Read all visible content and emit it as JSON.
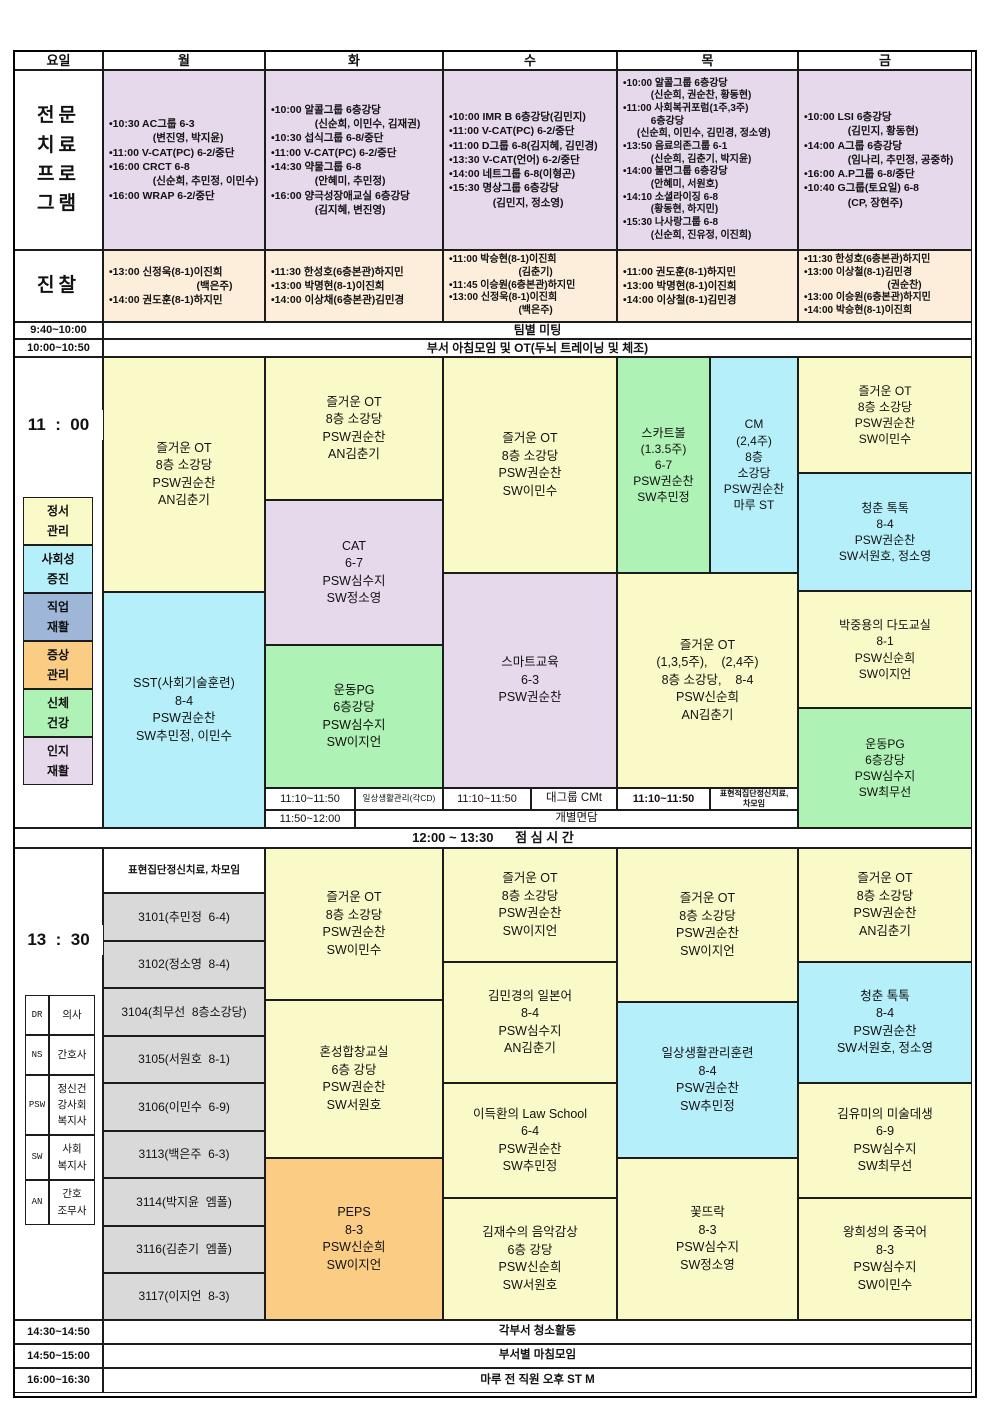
{
  "palette": {
    "category_yellow": "#fafac8",
    "category_cyan": "#b5f0fa",
    "category_blue": "#9eb6d8",
    "category_orange": "#fbcc84",
    "category_green": "#aef2b5",
    "category_lavender": "#e7d9ec",
    "exam_cream": "#fdeedb",
    "room_gray": "#d9d9d9"
  },
  "header": {
    "c0": "요일",
    "c1": "월",
    "c2": "화",
    "c3": "수",
    "c4": "목",
    "c5": "금"
  },
  "program": {
    "label": "전문\n치료\n프로\n그램",
    "mon": "•10:30 AC그룹 6-3\n               (변진영, 박지윤)\n•11:00 V-CAT(PC) 6-2/중단\n•16:00 CRCT 6-8\n               (신순희, 추민정, 이민수)\n•16:00 WRAP 6-2/중단",
    "tue": "•10:00 알콜그룹 6층강당\n               (신순희, 이민수, 김재권)\n•10:30 섭식그룹 6-8/중단\n•11:00 V-CAT(PC) 6-2/중단\n•14:30 약물그룹 6-8\n               (안혜미, 추민정)\n•16:00 양극성장애교실 6층강당\n               (김지혜, 변진영)",
    "wed": "•10:00 IMR B 6층강당(김민지)\n•11:00 V-CAT(PC) 6-2/중단\n•11:00 D그룹 6-8(김지혜, 김민경)\n•13:30 V-CAT(언어) 6-2/중단\n•14:00 네트그룹 6-8(이형곤)\n•15:30 명상그룹 6층강당\n               (김민지, 정소영)",
    "thu": "•10:00 알콜그룹 6층강당\n          (신순희, 권순찬, 황동현)\n•11:00 사회복귀포럼(1주,3주)\n          6층강당\n     (신순희, 이민수, 김민경, 정소영)\n•13:50 음료의존그룹 6-1\n          (신순희, 김춘기, 박지윤)\n•14:00 불면그룹 6층강당\n          (안혜미, 서원호)\n•14:10 소셜라이징 6-8\n          (황동현, 하지민)\n•15:30 나사랑그룹 6-8\n          (신순희, 진유정, 이진희)",
    "fri": "•10:00 LSI 6층강당\n               (김민지, 황동현)\n•14:00 A그룹 6층강당\n               (임나리, 추민정, 공중하)\n•16:00 A.P그룹 6-8/중단\n•10:40 G그룹(토요일) 6-8\n               (CP, 장현주)"
  },
  "exam": {
    "label": "진찰",
    "mon": "•13:00 신정욱(8-1)이진희\n                              (백은주)\n•14:00 권도훈(8-1)하지민",
    "tue": "•11:30 한성호(6층본관)하지민\n•13:00 박명현(8-1)이진희\n•14:00 이상채(6층본관)김민경",
    "wed": "•11:00 박승현(8-1)이진희\n                         (김춘기)\n•11:45 이승원(6층본관)하지민\n•13:00 신정욱(8-1)이진희\n                         (백은주)",
    "thu": "•11:00 권도훈(8-1)하지민\n•13:00 박명현(8-1)이진희\n•14:00 이상철(8-1)김민경",
    "fri": "•11:30 한성호(6층본관)하지민\n•13:00 이상철(8-1)김민경\n                              (권순찬)\n•13:00 이승원(6층본관)하지민\n•14:00 박승현(8-1)이진희"
  },
  "rows": {
    "team_time": "9:40~10:00",
    "team_text": "팀별 미팅",
    "morning_time": "10:00~10:50",
    "morning_text": "부서 아침모임 및 OT(두뇌 트레이닝 및 체조)",
    "lunch_text": "12:00 ~ 13:30      점 심 시 간",
    "clean_time": "14:30~14:50",
    "clean_text": "각부서 청소활동",
    "close_time": "14:50~15:00",
    "close_text": "부서별 마침모임",
    "st_time": "16:00~16:30",
    "st_text": "마루 전 직원 오후 ST M"
  },
  "s11": {
    "time_label": "11  :  00",
    "legend": [
      {
        "label": "정서\n관리",
        "color": "#fafac8"
      },
      {
        "label": "사회성\n증진",
        "color": "#b5f0fa"
      },
      {
        "label": "직업\n재활",
        "color": "#9eb6d8"
      },
      {
        "label": "증상\n관리",
        "color": "#fbcc84"
      },
      {
        "label": "신체\n건강",
        "color": "#aef2b5"
      },
      {
        "label": "인지\n재활",
        "color": "#e7d9ec"
      }
    ],
    "mon": {
      "ot": "즐거운 OT\n8층 소강당\nPSW권순찬\nAN김춘기",
      "sst": "SST(사회기술훈련)\n8-4\nPSW권순찬\nSW추민정, 이민수"
    },
    "tue": {
      "ot": "즐거운 OT\n8층 소강당\nPSW권순찬\nAN김춘기",
      "cat": "CAT\n6-7\nPSW심수지\nSW정소영",
      "pg": "운동PG\n6층강당\nPSW심수지\nSW이지언",
      "t1": "11:10~11:50",
      "t1_text": "일상생활관리(각CD)",
      "t2": "11:50~12:00"
    },
    "wed": {
      "ot": "즐거운 OT\n8층 소강당\nPSW권순찬\nSW이민수",
      "smart": "스마트교육\n6-3\nPSW권순찬",
      "t1": "11:10~11:50",
      "t1_text": "대그룹 CMt"
    },
    "thu": {
      "skat": "스카트볼\n(1.3.5주)\n6-7\nPSW권순찬\nSW추민정",
      "cm": "CM\n(2,4주)\n8층\n소강당\nPSW권순찬\n마루 ST",
      "ot": "즐거운 OT\n(1,3,5주),    (2,4주)\n8층 소강당,    8-4\nPSW신순희\nAN김춘기",
      "t1": "11:10~11:50",
      "t1_text": "표현적집단정신치료,\n차모임"
    },
    "fri": {
      "ot": "즐거운 OT\n8층 소강당\nPSW권순찬\nSW이민수",
      "talk": "청춘 톡톡\n8-4\nPSW권순찬\nSW서원호, 정소영",
      "tea": "박중용의 다도교실\n8-1\nPSW신순희\nSW이지언",
      "pg": "운동PG\n6층강당\nPSW심수지\nSW최무선"
    },
    "consult": "개별면담"
  },
  "s13": {
    "time_label": "13  :  30",
    "legend": [
      {
        "code": "DR",
        "label": "의사"
      },
      {
        "code": "NS",
        "label": "간호사"
      },
      {
        "code": "PSW",
        "label": "정신건\n강사회\n복지사"
      },
      {
        "code": "SW",
        "label": "사회\n복지사"
      },
      {
        "code": "AN",
        "label": "간호\n조무사"
      }
    ],
    "mon": [
      "표현집단정신치료, 차모임",
      "3101(추민정  6-4)",
      "3102(정소영  8-4)",
      "3104(최무선  8층소강당)",
      "3105(서원호  8-1)",
      "3106(이민수  6-9)",
      "3113(백은주  6-3)",
      "3114(박지윤  엠폴)",
      "3116(김춘기  엠폴)",
      "3117(이지언  8-3)"
    ],
    "tue": [
      "즐거운 OT\n8층 소강당\nPSW권순찬\nSW이민수",
      "혼성합창교실\n6층 강당\nPSW권순찬\nSW서원호",
      "PEPS\n8-3\nPSW신순희\nSW이지언"
    ],
    "wed": [
      "즐거운 OT\n8층 소강당\nPSW권순찬\nSW이지언",
      "김민경의 일본어\n8-4\nPSW심수지\nAN김춘기",
      "이득환의 Law School\n6-4\nPSW권순찬\nSW추민정",
      "김재수의 음악감상\n6층 강당\nPSW신순희\nSW서원호"
    ],
    "thu": [
      "즐거운 OT\n8층 소강당\nPSW권순찬\nSW이지언",
      "일상생활관리훈련\n8-4\nPSW권순찬\nSW추민정",
      "꽃뜨락\n8-3\nPSW심수지\nSW정소영"
    ],
    "fri": [
      "즐거운 OT\n8층 소강당\nPSW권순찬\nAN김춘기",
      "청춘 톡톡\n8-4\nPSW권순찬\nSW서원호, 정소영",
      "김유미의 미술데생\n6-9\nPSW심수지\nSW최무선",
      "왕희성의 중국어\n8-3\nPSW심수지\nSW이민수"
    ]
  }
}
